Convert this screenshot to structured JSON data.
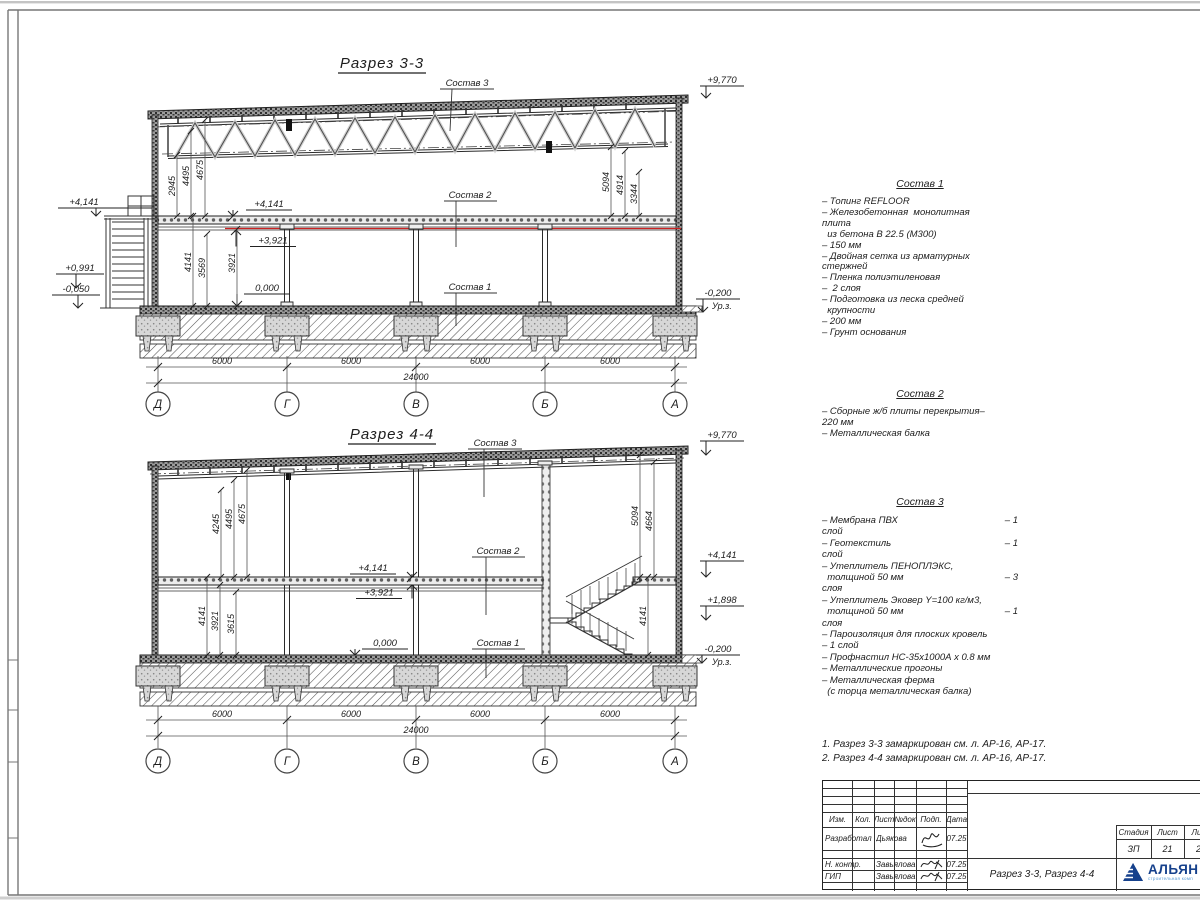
{
  "sections": {
    "s33": {
      "title": "Разрез 3-3",
      "labels": {
        "sostav1": "Состав 1",
        "sostav2": "Состав 2",
        "sostav3": "Состав 3"
      },
      "elevations": {
        "roof": "+9,770",
        "landing_out": "+4,141",
        "mid_out": "+0,991",
        "grade_out": "-0,050",
        "slab": "+4,141",
        "slab_under": "+3,921",
        "floor": "0,000",
        "ground": "-0,200",
        "ground_label": "Ур.з."
      },
      "dims": {
        "left_upper": [
          "2945",
          "4495",
          "4675"
        ],
        "left_lower": [
          "4141",
          "3569",
          "3921"
        ],
        "right": [
          "5094",
          "4914",
          "3344"
        ],
        "bottom": [
          "6000",
          "6000",
          "6000",
          "6000"
        ],
        "total": "24000"
      },
      "axes": [
        "Д",
        "Г",
        "В",
        "Б",
        "А"
      ]
    },
    "s44": {
      "title": "Разрез 4-4",
      "labels": {
        "sostav1": "Состав 1",
        "sostav2": "Состав 2",
        "sostav3": "Состав 3"
      },
      "elevations": {
        "roof": "+9,770",
        "slab": "+4,141",
        "slab_under": "+3,921",
        "floor": "0,000",
        "slab_right": "+4,141",
        "landing": "+1,898",
        "ground": "-0,200",
        "ground_label": "Ур.з."
      },
      "dims": {
        "left_upper": [
          "4245",
          "4495",
          "4675"
        ],
        "left_lower": [
          "4141",
          "3921",
          "3615"
        ],
        "right_upper": [
          "5094",
          "4664"
        ],
        "right_lower": "4141",
        "bottom": [
          "6000",
          "6000",
          "6000",
          "6000"
        ],
        "total": "24000"
      },
      "axes": [
        "Д",
        "Г",
        "В",
        "Б",
        "А"
      ]
    }
  },
  "specs": {
    "sostav1": {
      "title": "Состав 1",
      "lines": [
        "– Топинг REFLOOR",
        "– Железобетонная  монолитная",
        "плита",
        "  из бетона В 22.5 (М300)",
        "– 150 мм",
        "– Двойная сетка из арматурных",
        "стержней",
        "– Пленка полиэтиленовая",
        "–  2 слоя",
        "– Подготовка из песка средней",
        "  крупности",
        "– 200 мм",
        "– Грунт основания"
      ]
    },
    "sostav2": {
      "title": "Состав 2",
      "lines": [
        "– Сборные ж/б плиты перекрытия–",
        "220 мм",
        "– Металлическая балка"
      ]
    },
    "sostav3": {
      "title": "Состав 3",
      "lines": [
        [
          "– Мембрана ПВХ",
          "– 1"
        ],
        "слой",
        [
          "– Геотекстиль",
          "– 1"
        ],
        "слой",
        "– Утеплитель ПЕНОПЛЭКС,",
        [
          "  толщиной 50 мм",
          "– 3"
        ],
        "слоя",
        "– Утеплитель Эковер Y=100 кг/м3,",
        [
          "  толщиной 50 мм",
          "– 1"
        ],
        "слоя",
        "– Пароизоляция для плоских кровель",
        "– 1 слой",
        "– Профнастил НС-35х1000А х 0.8 мм",
        "– Металлические прогоны",
        "– Металлическая ферма",
        "  (с торца металлическая балка)"
      ]
    }
  },
  "notes": [
    "1. Разрез 3-3 замаркирован см. л. АР-16, АР-17.",
    "2. Разрез 4-4 замаркирован см. л. АР-16, АР-17."
  ],
  "titleblock": {
    "headers": [
      "Изм.",
      "Кол.",
      "Лист",
      "№док",
      "Подп.",
      "Дата"
    ],
    "rows": {
      "r1": {
        "role": "Разработал",
        "name": "Дьякова",
        "date": "07.25"
      },
      "r2": {
        "role": "Н. контр.",
        "name": "Завьялова",
        "date": "07.25"
      },
      "r3": {
        "role": "ГИП",
        "name": "Завьялова",
        "date": "07.25"
      }
    },
    "doc_title": "Разрез 3-3, Разрез 4-4",
    "stage_label": "Стадия",
    "stage": "ЗП",
    "sheet_label": "Лист",
    "sheet": "21",
    "sheets_label": "Лис",
    "sheets": "2",
    "logo": {
      "name": "АЛЬЯН",
      "tagline": "строительная комп"
    }
  },
  "colors": {
    "accent_red": "#cc2222",
    "logo_blue": "#16418c",
    "logo_light": "#5a9bd5"
  }
}
